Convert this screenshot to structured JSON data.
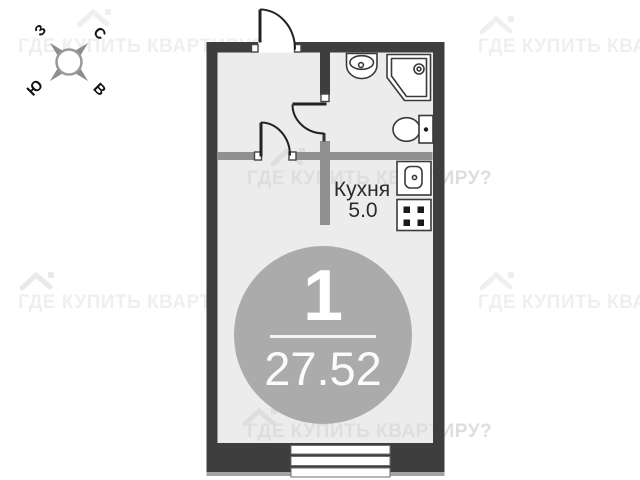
{
  "compass": {
    "north": "С",
    "south": "Ю",
    "west": "З",
    "east": "В"
  },
  "watermark": {
    "text": "ГДЕ КУПИТЬ КВАРТИРУ?"
  },
  "plan": {
    "kitchen_label": "Кухня",
    "kitchen_area": "5.0",
    "rooms_count": "1",
    "total_area": "27.52",
    "colors": {
      "outer_wall": "#3e3e3e",
      "partition": "#909090",
      "floor": "#ececec",
      "badge_circle": "#ababab",
      "fixture_outline": "#3a3a3a",
      "watermark_outside": "#efefef",
      "watermark_inside": "#dedede"
    }
  }
}
